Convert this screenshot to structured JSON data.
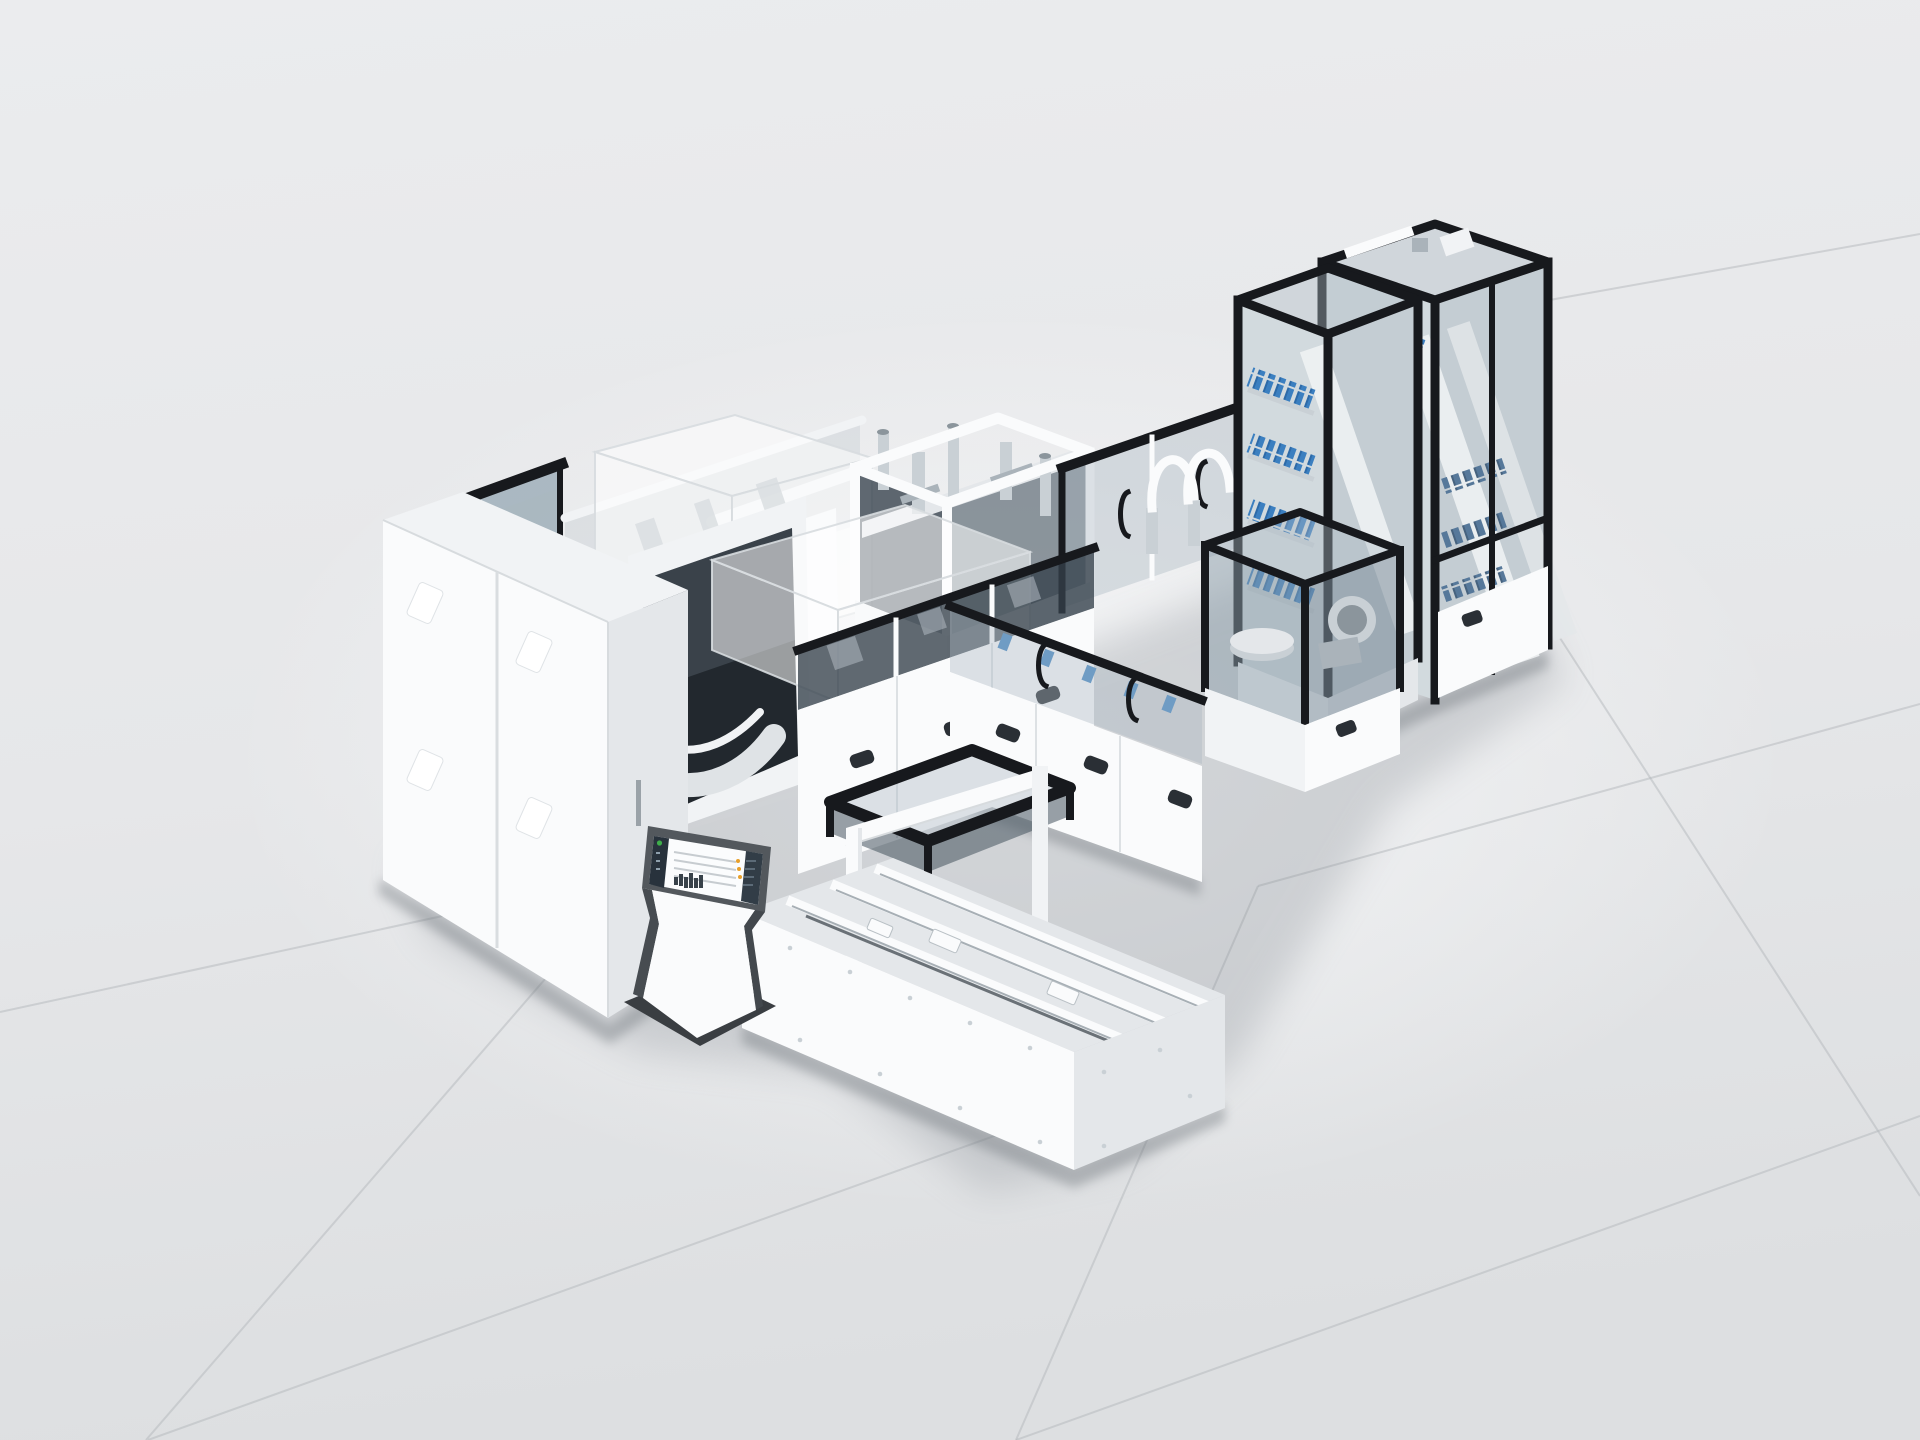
{
  "scene": {
    "subject": "modular-automated-assembly-line-3d-render",
    "view": "isometric-studio-shot",
    "floor": {
      "style": "large-light-gray-tiles",
      "visible_seam_lines": 8
    },
    "modules": [
      "electrical-cabinet-bank",
      "control-kiosk-with-touchscreen",
      "curved-conveyor-window-module",
      "teal-glass-enclosure",
      "ghost-transparent-future-module-small",
      "ghost-transparent-future-module-wide",
      "open-frame-process-module-with-actuators",
      "glass-tunnel-with-door-handles-and-hoses",
      "center-base-cabinet-row",
      "front-right-glass-wall-leg",
      "corner-process-cell-with-turntable",
      "component-tower-front-with-blue-trays",
      "component-tower-rear-with-gray-trays",
      "outfeed-canopy-and-portal",
      "transfer-conveyor-deck-with-linear-rails"
    ],
    "kiosk_screen": {
      "status_dot": "green",
      "sidebar": "dark-icon-rail",
      "content": "list-rows-with-mini-bar-chart",
      "accent_dots": "orange"
    }
  },
  "palette": {
    "seam": "#b4b8bc",
    "shadow-soft": "#8d939a",
    "shadow-contact": "#6d7379",
    "white-bright": "#fafbfc",
    "white-mid": "#f1f3f5",
    "white-shade": "#e4e7ea",
    "white-dark": "#d4d8db",
    "steel-light": "#c9d0d5",
    "steel-mid": "#aab3ba",
    "steel-dark": "#8b959c",
    "frame-black": "#17191d",
    "frame-dark": "#2a2f35",
    "glass-light": "rgba(173,186,196,0.40)",
    "glass-mid": "rgba(140,157,170,0.50)",
    "glass-dark": "rgba(52,64,74,0.78)",
    "glass-deep": "rgba(72,86,98,0.60)",
    "glass-teal": "rgba(116,142,156,0.55)",
    "glass-corner": "rgba(125,142,155,0.55)",
    "canopy-side": "rgba(70,84,94,0.55)",
    "window-dark": "#22282e",
    "ghost-fill": "rgba(255,255,255,0.55)",
    "ghost-edge": "rgba(215,219,223,0.9)",
    "tower-face-l": "#d2dade",
    "tower-face-r": "#c4cdd3",
    "blue-bright": "#3b7fc0",
    "blue-mid": "#6f9cc4",
    "blue-gray": "#56789a",
    "orange": "#dd5f1f",
    "amber": "#e8a02c",
    "green": "#3fae4a",
    "kiosk-frame": "#53585d",
    "kiosk-side": "#474c51",
    "kiosk-side2": "#43484d",
    "kiosk-base": "#3a3e42",
    "screen-bg": "#fbfcfd",
    "screen-sidebar": "#28323c",
    "screen-panel": "#323d47",
    "screen-line": "#c7ccd0",
    "screen-chart": "#39424a"
  }
}
